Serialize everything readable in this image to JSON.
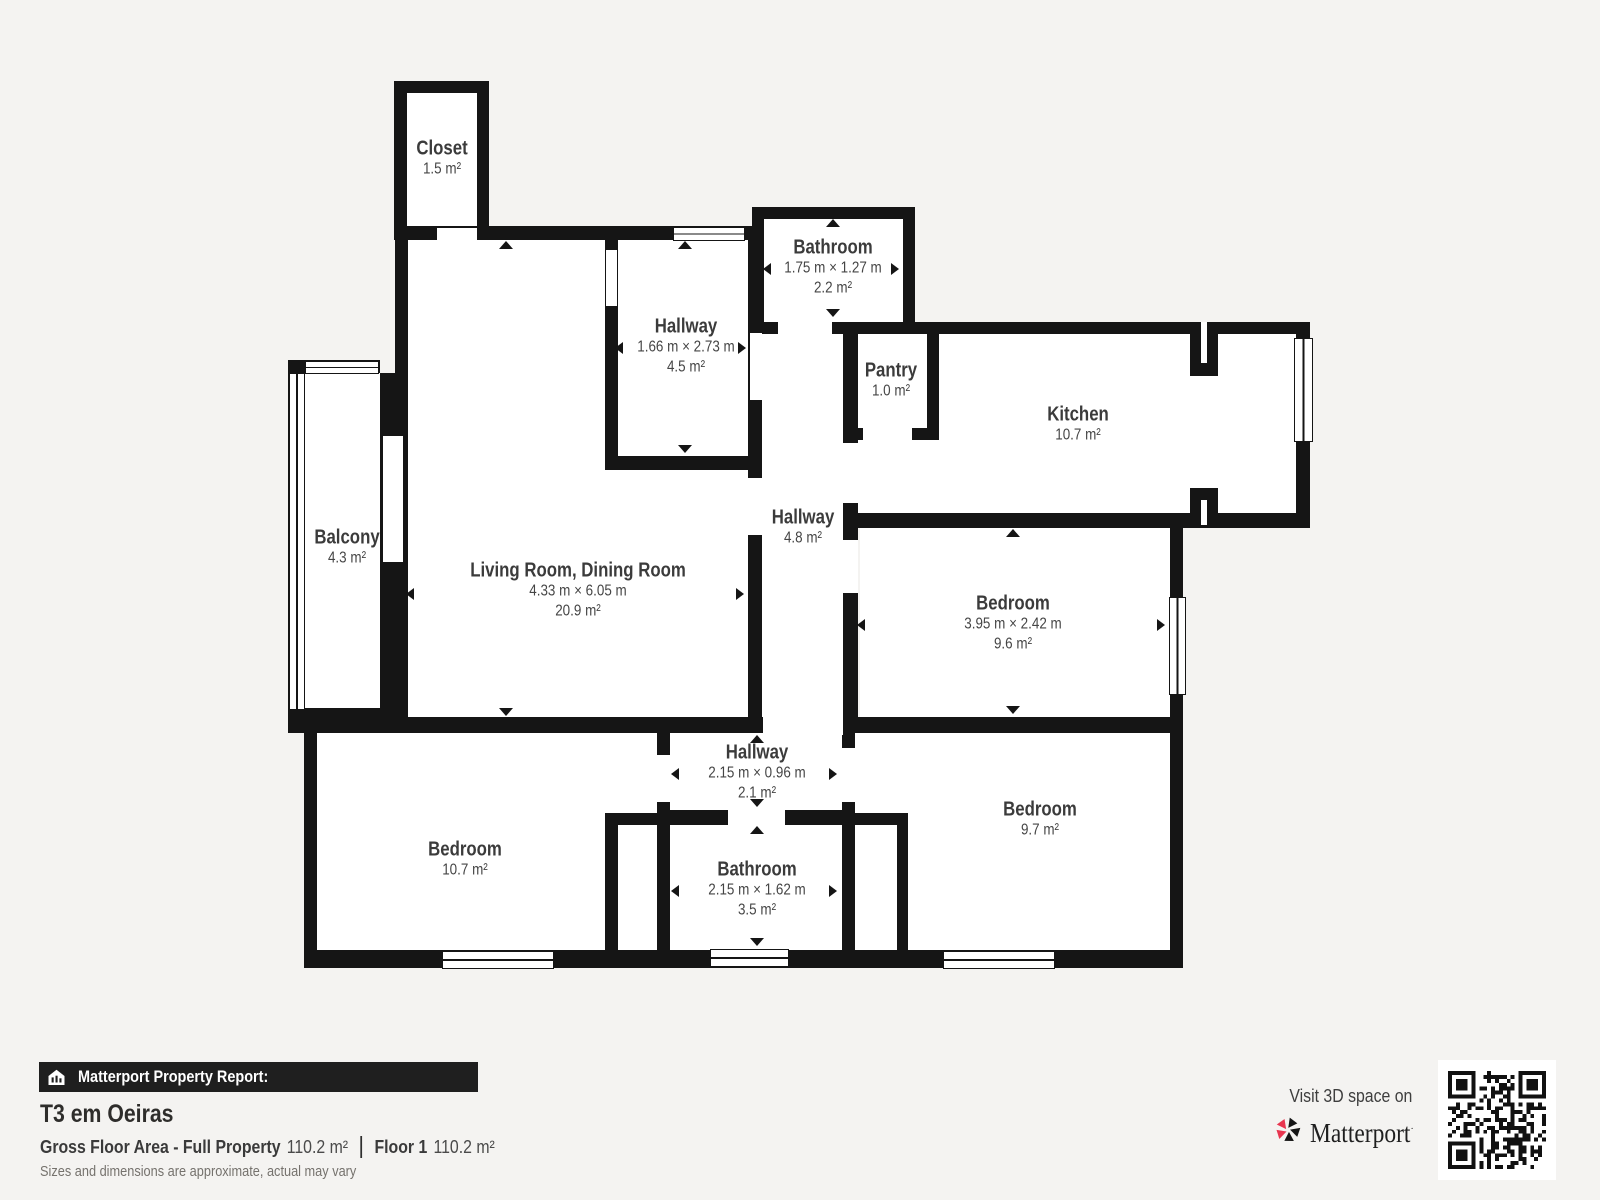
{
  "page": {
    "background": "#f4f3f1",
    "wall_color": "#151515",
    "room_fill": "#ffffff"
  },
  "floor_plan": {
    "rooms": [
      {
        "id": "closet",
        "name": "Closet",
        "dimensions": "",
        "area": "1.5 m²"
      },
      {
        "id": "bathroom-top",
        "name": "Bathroom",
        "dimensions": "1.75 m × 1.27 m",
        "area": "2.2 m²"
      },
      {
        "id": "hallway-top",
        "name": "Hallway",
        "dimensions": "1.66 m × 2.73 m",
        "area": "4.5 m²"
      },
      {
        "id": "pantry",
        "name": "Pantry",
        "dimensions": "",
        "area": "1.0 m²"
      },
      {
        "id": "kitchen",
        "name": "Kitchen",
        "dimensions": "",
        "area": "10.7 m²"
      },
      {
        "id": "balcony",
        "name": "Balcony",
        "dimensions": "",
        "area": "4.3 m²"
      },
      {
        "id": "living-dining",
        "name": "Living Room, Dining Room",
        "dimensions": "4.33 m × 6.05 m",
        "area": "20.9 m²"
      },
      {
        "id": "hallway-center",
        "name": "Hallway",
        "dimensions": "",
        "area": "4.8 m²"
      },
      {
        "id": "bedroom-middle",
        "name": "Bedroom",
        "dimensions": "3.95 m × 2.42 m",
        "area": "9.6 m²"
      },
      {
        "id": "hallway-bottom",
        "name": "Hallway",
        "dimensions": "2.15 m × 0.96 m",
        "area": "2.1 m²"
      },
      {
        "id": "bedroom-left",
        "name": "Bedroom",
        "dimensions": "",
        "area": "10.7 m²"
      },
      {
        "id": "bathroom-bottom",
        "name": "Bathroom",
        "dimensions": "2.15 m × 1.62 m",
        "area": "3.5 m²"
      },
      {
        "id": "bedroom-right",
        "name": "Bedroom",
        "dimensions": "",
        "area": "9.7 m²"
      }
    ]
  },
  "footer": {
    "report_label": "Matterport Property Report:",
    "property_title": "T3 em Oeiras",
    "gross_floor_area_label": "Gross Floor Area - Full Property",
    "gross_floor_area_value": "110.2 m²",
    "floor_label": "Floor 1",
    "floor_value": "110.2 m²",
    "disclaimer": "Sizes and dimensions are approximate, actual may vary",
    "visit_text": "Visit 3D space on",
    "brand_name": "Matterport",
    "icons": {
      "report_icon": "house-chart-icon",
      "brand_icon": "matterport-pinwheel-icon",
      "qr": "qr-code"
    },
    "colors": {
      "bar_bg": "#1f1f1f",
      "brand_red": "#e8354f"
    }
  }
}
